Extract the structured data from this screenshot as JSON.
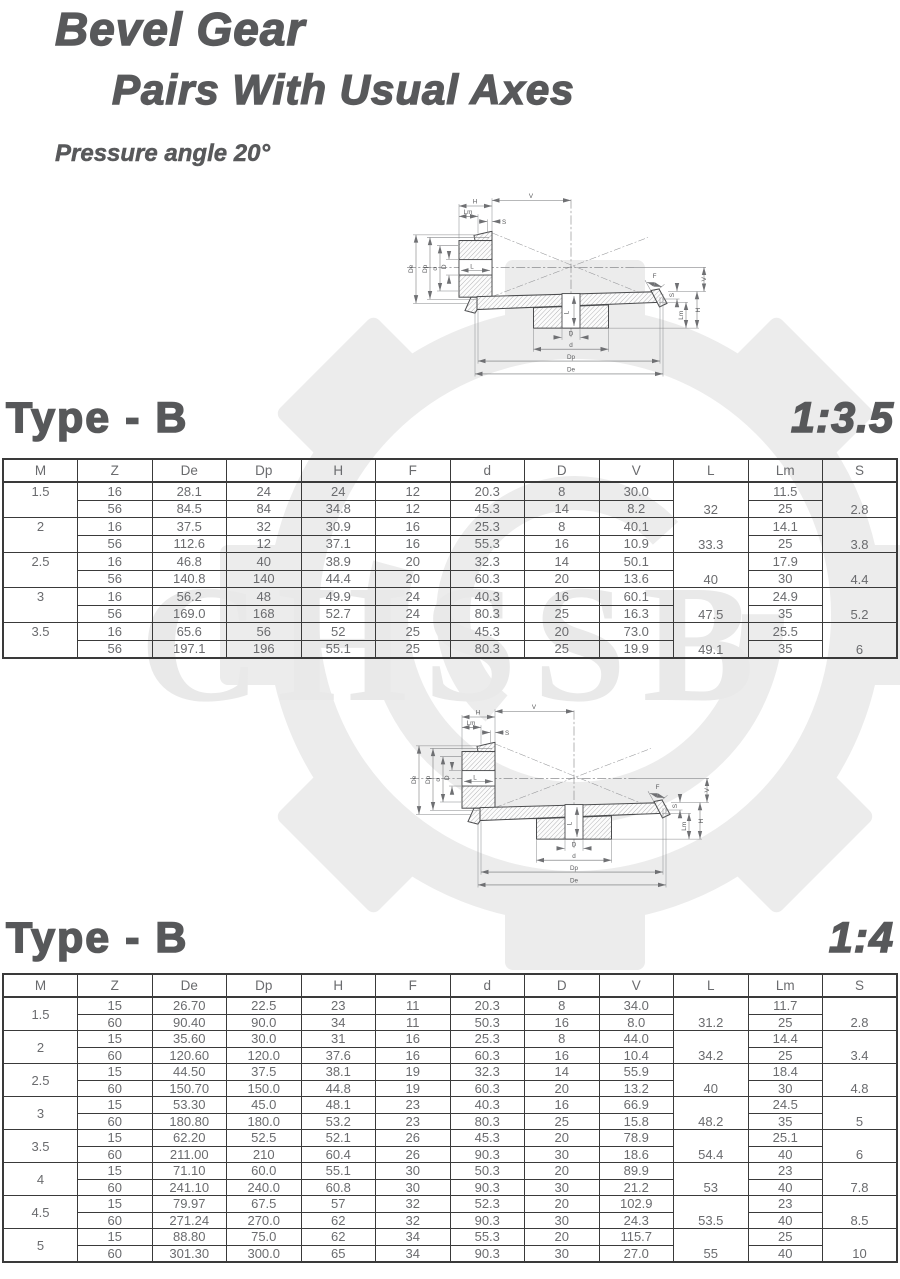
{
  "header": {
    "title_line1": "Bevel Gear",
    "title_line2": "Pairs With Usual Axes",
    "subtitle": "Pressure angle 20°"
  },
  "watermark": {
    "text": "CHSSB"
  },
  "diagram": {
    "labels": {
      "v": "V",
      "h": "H",
      "lm": "Lm",
      "s": "S",
      "de": "De",
      "dp": "Dp",
      "d_small": "d",
      "d_big": "D",
      "l": "L",
      "f": "F"
    }
  },
  "sections": [
    {
      "heading": "Type - B",
      "ratio": "1:3.5",
      "columns": [
        "M",
        "Z",
        "De",
        "Dp",
        "H",
        "F",
        "d",
        "D",
        "V",
        "L",
        "Lm",
        "S"
      ],
      "groups": [
        {
          "m": "1.5",
          "l": "32",
          "s": "2.8",
          "rows": [
            {
              "z": "16",
              "de": "28.1",
              "dp": "24",
              "h": "24",
              "f": "12",
              "d": "20.3",
              "D": "8",
              "v": "30.0",
              "lm": "11.5"
            },
            {
              "z": "56",
              "de": "84.5",
              "dp": "84",
              "h": "34.8",
              "f": "12",
              "d": "45.3",
              "D": "14",
              "v": "8.2",
              "lm": "25"
            }
          ]
        },
        {
          "m": "2",
          "l": "33.3",
          "s": "3.8",
          "rows": [
            {
              "z": "16",
              "de": "37.5",
              "dp": "32",
              "h": "30.9",
              "f": "16",
              "d": "25.3",
              "D": "8",
              "v": "40.1",
              "lm": "14.1"
            },
            {
              "z": "56",
              "de": "112.6",
              "dp": "12",
              "h": "37.1",
              "f": "16",
              "d": "55.3",
              "D": "16",
              "v": "10.9",
              "lm": "25"
            }
          ]
        },
        {
          "m": "2.5",
          "l": "40",
          "s": "4.4",
          "rows": [
            {
              "z": "16",
              "de": "46.8",
              "dp": "40",
              "h": "38.9",
              "f": "20",
              "d": "32.3",
              "D": "14",
              "v": "50.1",
              "lm": "17.9"
            },
            {
              "z": "56",
              "de": "140.8",
              "dp": "140",
              "h": "44.4",
              "f": "20",
              "d": "60.3",
              "D": "20",
              "v": "13.6",
              "lm": "30"
            }
          ]
        },
        {
          "m": "3",
          "l": "47.5",
          "s": "5.2",
          "rows": [
            {
              "z": "16",
              "de": "56.2",
              "dp": "48",
              "h": "49.9",
              "f": "24",
              "d": "40.3",
              "D": "16",
              "v": "60.1",
              "lm": "24.9"
            },
            {
              "z": "56",
              "de": "169.0",
              "dp": "168",
              "h": "52.7",
              "f": "24",
              "d": "80.3",
              "D": "25",
              "v": "16.3",
              "lm": "35"
            }
          ]
        },
        {
          "m": "3.5",
          "l": "49.1",
          "s": "6",
          "rows": [
            {
              "z": "16",
              "de": "65.6",
              "dp": "56",
              "h": "52",
              "f": "25",
              "d": "45.3",
              "D": "20",
              "v": "73.0",
              "lm": "25.5"
            },
            {
              "z": "56",
              "de": "197.1",
              "dp": "196",
              "h": "55.1",
              "f": "25",
              "d": "80.3",
              "D": "25",
              "v": "19.9",
              "lm": "35"
            }
          ]
        }
      ]
    },
    {
      "heading": "Type - B",
      "ratio": "1:4",
      "columns": [
        "M",
        "Z",
        "De",
        "Dp",
        "H",
        "F",
        "d",
        "D",
        "V",
        "L",
        "Lm",
        "S"
      ],
      "groups": [
        {
          "m": "1.5",
          "l": "31.2",
          "s": "2.8",
          "rows": [
            {
              "z": "15",
              "de": "26.70",
              "dp": "22.5",
              "h": "23",
              "f": "11",
              "d": "20.3",
              "D": "8",
              "v": "34.0",
              "lm": "11.7"
            },
            {
              "z": "60",
              "de": "90.40",
              "dp": "90.0",
              "h": "34",
              "f": "11",
              "d": "50.3",
              "D": "16",
              "v": "8.0",
              "lm": "25"
            }
          ]
        },
        {
          "m": "2",
          "l": "34.2",
          "s": "3.4",
          "rows": [
            {
              "z": "15",
              "de": "35.60",
              "dp": "30.0",
              "h": "31",
              "f": "16",
              "d": "25.3",
              "D": "8",
              "v": "44.0",
              "lm": "14.4"
            },
            {
              "z": "60",
              "de": "120.60",
              "dp": "120.0",
              "h": "37.6",
              "f": "16",
              "d": "60.3",
              "D": "16",
              "v": "10.4",
              "lm": "25"
            }
          ]
        },
        {
          "m": "2.5",
          "l": "40",
          "s": "4.8",
          "rows": [
            {
              "z": "15",
              "de": "44.50",
              "dp": "37.5",
              "h": "38.1",
              "f": "19",
              "d": "32.3",
              "D": "14",
              "v": "55.9",
              "lm": "18.4"
            },
            {
              "z": "60",
              "de": "150.70",
              "dp": "150.0",
              "h": "44.8",
              "f": "19",
              "d": "60.3",
              "D": "20",
              "v": "13.2",
              "lm": "30"
            }
          ]
        },
        {
          "m": "3",
          "l": "48.2",
          "s": "5",
          "rows": [
            {
              "z": "15",
              "de": "53.30",
              "dp": "45.0",
              "h": "48.1",
              "f": "23",
              "d": "40.3",
              "D": "16",
              "v": "66.9",
              "lm": "24.5"
            },
            {
              "z": "60",
              "de": "180.80",
              "dp": "180.0",
              "h": "53.2",
              "f": "23",
              "d": "80.3",
              "D": "25",
              "v": "15.8",
              "lm": "35"
            }
          ]
        },
        {
          "m": "3.5",
          "l": "54.4",
          "s": "6",
          "rows": [
            {
              "z": "15",
              "de": "62.20",
              "dp": "52.5",
              "h": "52.1",
              "f": "26",
              "d": "45.3",
              "D": "20",
              "v": "78.9",
              "lm": "25.1"
            },
            {
              "z": "60",
              "de": "211.00",
              "dp": "210",
              "h": "60.4",
              "f": "26",
              "d": "90.3",
              "D": "30",
              "v": "18.6",
              "lm": "40"
            }
          ]
        },
        {
          "m": "4",
          "l": "53",
          "s": "7.8",
          "rows": [
            {
              "z": "15",
              "de": "71.10",
              "dp": "60.0",
              "h": "55.1",
              "f": "30",
              "d": "50.3",
              "D": "20",
              "v": "89.9",
              "lm": "23"
            },
            {
              "z": "60",
              "de": "241.10",
              "dp": "240.0",
              "h": "60.8",
              "f": "30",
              "d": "90.3",
              "D": "30",
              "v": "21.2",
              "lm": "40"
            }
          ]
        },
        {
          "m": "4.5",
          "l": "53.5",
          "s": "8.5",
          "rows": [
            {
              "z": "15",
              "de": "79.97",
              "dp": "67.5",
              "h": "57",
              "f": "32",
              "d": "52.3",
              "D": "20",
              "v": "102.9",
              "lm": "23"
            },
            {
              "z": "60",
              "de": "271.24",
              "dp": "270.0",
              "h": "62",
              "f": "32",
              "d": "90.3",
              "D": "30",
              "v": "24.3",
              "lm": "40"
            }
          ]
        },
        {
          "m": "5",
          "l": "55",
          "s": "10",
          "rows": [
            {
              "z": "15",
              "de": "88.80",
              "dp": "75.0",
              "h": "62",
              "f": "34",
              "d": "55.3",
              "D": "20",
              "v": "115.7",
              "lm": "25"
            },
            {
              "z": "60",
              "de": "301.30",
              "dp": "300.0",
              "h": "65",
              "f": "34",
              "d": "90.3",
              "D": "30",
              "v": "27.0",
              "lm": "40"
            }
          ]
        }
      ]
    }
  ]
}
